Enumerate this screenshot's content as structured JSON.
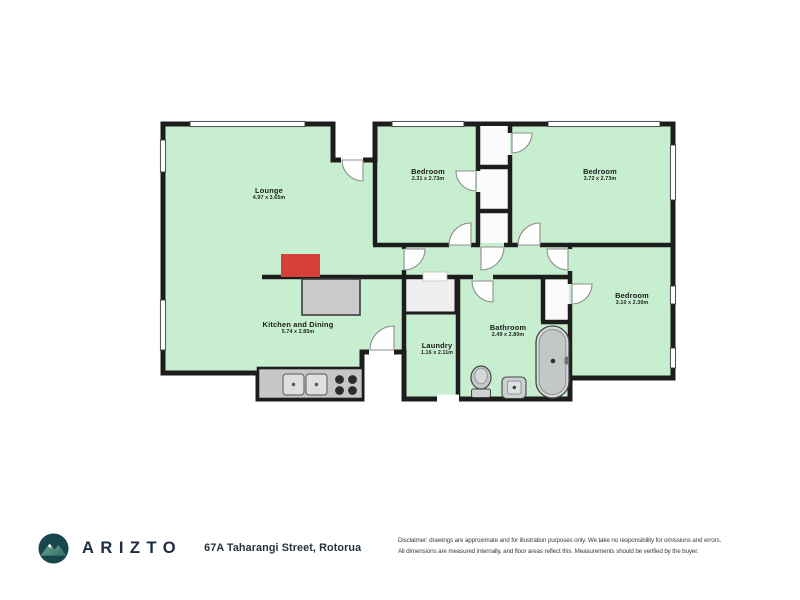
{
  "floorplan": {
    "rooms": {
      "lounge": {
        "name": "Lounge",
        "dims": "4.97 x 3.65m"
      },
      "bedroom1": {
        "name": "Bedroom",
        "dims": "2.31 x 2.73m"
      },
      "bedroom2": {
        "name": "Bedroom",
        "dims": "3.72 x 2.73m"
      },
      "bedroom3": {
        "name": "Bedroom",
        "dims": "3.10 x 2.30m"
      },
      "kitchen": {
        "name": "Kitchen and Dining",
        "dims": "5.74 x 2.85m"
      },
      "laundry": {
        "name": "Laundry",
        "dims": "1.16 x 2.11m"
      },
      "bathroom": {
        "name": "Bathroom",
        "dims": "2.49 x 2.80m"
      }
    },
    "colors": {
      "room_fill": "#c7efcf",
      "wall": "#1d1d1d",
      "feature_red": "#d6403a",
      "counter_gray": "#c6c6c6"
    }
  },
  "footer": {
    "brand": "ARIZTO",
    "address": "67A Taharangi Street, Rotorua",
    "disclaimer_line1": "Disclaimer: drawings are approximate and for illustration purposes only. We take no responsibility for omissions and errors.",
    "disclaimer_line2": "All dimensions are measured internally, and floor areas reflect this. Measurements should be verified by the buyer."
  }
}
